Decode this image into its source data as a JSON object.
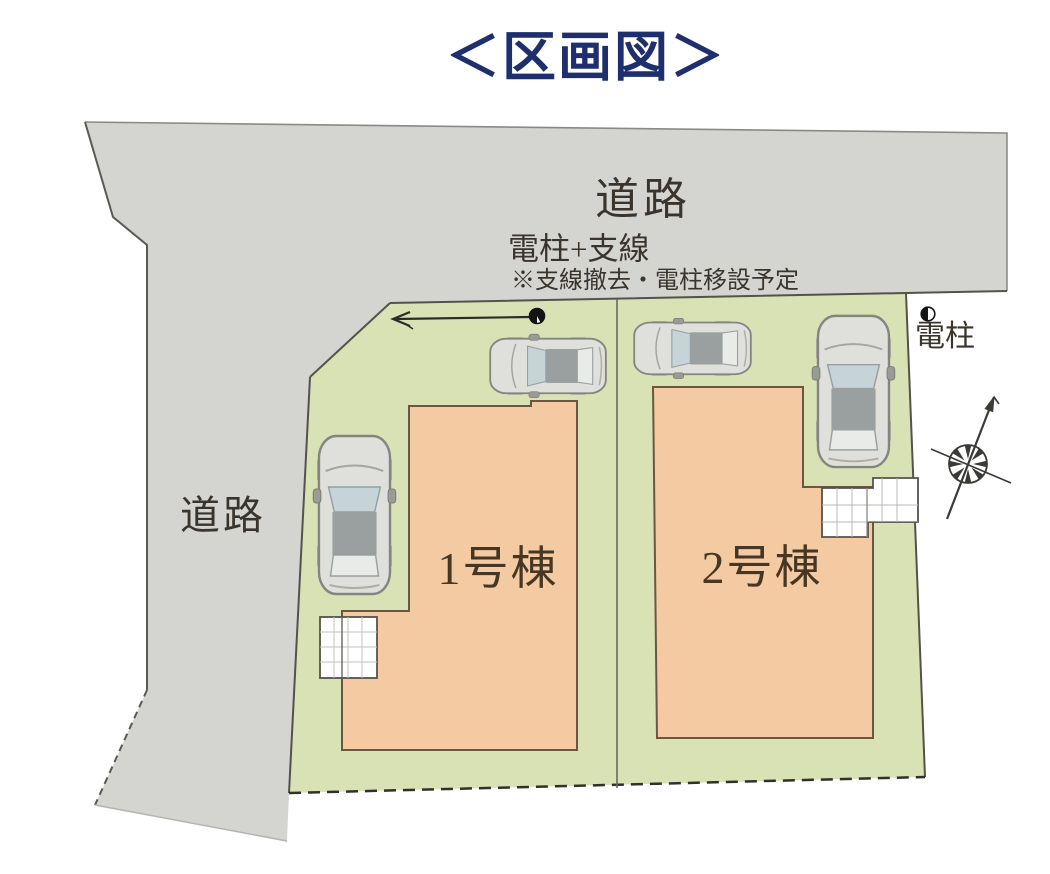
{
  "title": "＜区画図＞",
  "plan": {
    "road_top_label": "道路",
    "road_left_label": "道路",
    "pole_wire_label": "電柱+支線",
    "pole_wire_note": "※支線撤去・電柱移設予定",
    "pole_right_label": "電柱",
    "building1_label": "1号棟",
    "building2_label": "2号棟"
  },
  "icons": {
    "pole_on_plot": "utility-pole-symbol",
    "pole_right": "utility-pole-symbol",
    "guy_wire_arrow": "left-arrow",
    "north": "compass-north-arrow",
    "cars": "car-top-view",
    "decks": "white-grid-terrace"
  },
  "colors": {
    "title_text": "#1f2f6e",
    "road_gray": "#d4d4d1",
    "plot_green": "#d9e2b5",
    "building_peach": "#f4caa2",
    "outline_dark": "#56524a",
    "label_text": "#3a352c"
  }
}
